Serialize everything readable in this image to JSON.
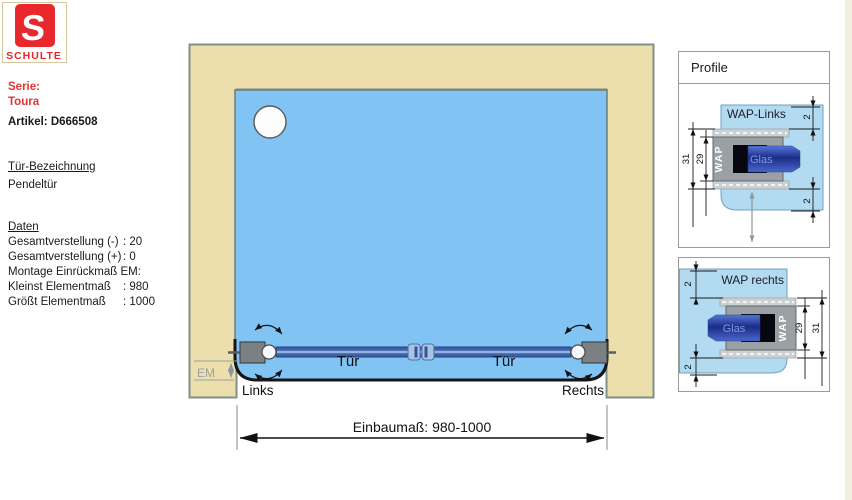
{
  "logo": {
    "letter": "S",
    "name": "SCHULTE"
  },
  "info": {
    "serie_label": "Serie:",
    "serie_value": "Toura",
    "artikel": "Artikel: D666508",
    "door_heading": "Tür-Bezeichnung",
    "door_type": "Pendeltür",
    "data_heading": "Daten",
    "rows": [
      {
        "label": "Gesamtverstellung (-)",
        "value": ": 20"
      },
      {
        "label": "Gesamtverstellung (+)",
        "value": ": 0"
      },
      {
        "label": "Montage Einrückmaß EM:",
        "value": ""
      },
      {
        "label": "Kleinst Elementmaß",
        "value": ": 980"
      },
      {
        "label": "Größt Elementmaß",
        "value": ": 1000"
      }
    ]
  },
  "drawing": {
    "tuer_left": "Tür",
    "tuer_right": "Tür",
    "links": "Links",
    "rechts": "Rechts",
    "em": "EM",
    "einbaumass": "Einbaumaß: 980-1000"
  },
  "profile": {
    "title": "Profile",
    "links": {
      "title": "WAP-Links",
      "wap": "WAP",
      "glas": "Glas",
      "dim_outer": "31",
      "dim_inner": "29",
      "dim_top": "2",
      "dim_bottom": "2"
    },
    "rechts": {
      "title": "WAP rechts",
      "wap": "WAP",
      "glas": "Glas",
      "dim_outer": "31",
      "dim_inner": "29",
      "dim_top": "2",
      "dim_bottom": "2"
    }
  },
  "colors": {
    "logo_red": "#e8282c",
    "wall_beige": "#ecdfad",
    "glass_blue": "#81c3f2",
    "profile_blue": "#b2daf0",
    "door_blue": "#3c5fa8"
  }
}
